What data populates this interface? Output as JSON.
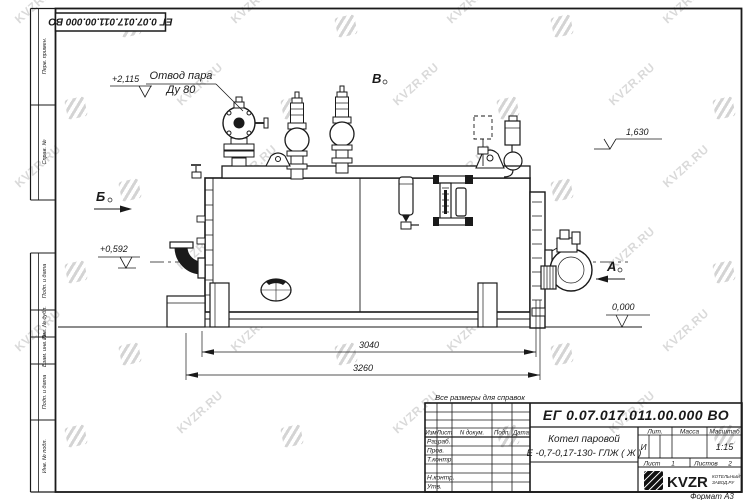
{
  "doc": {
    "number": "ЕГ 0.07.017.011.00.000  ВО",
    "number_top": "ЕГ 0.07.017.011.00.000  ВО",
    "title_line1": "Котел паровой",
    "title_line2": "Е -0,7-0,17-130- ГЛЖ ( Ж )",
    "litera_label": "Лит.",
    "litera": "И",
    "mass_label": "Масса",
    "scale_label": "Масштаб",
    "scale": "1:15",
    "sheet_label": "Лист",
    "sheet_value": "1",
    "sheets_label": "Листов",
    "sheets_value": "2",
    "format_label": "Формат А3",
    "reference_note": "Все размеры для справок"
  },
  "titleblock": {
    "header_cols": [
      "Изм",
      "Лист",
      "N докум.",
      "Подп.",
      "Дата"
    ],
    "rows": [
      "Разраб.",
      "Пров.",
      "Т.контр.",
      "",
      "Н.контр.",
      "Утв."
    ]
  },
  "frame_labels": [
    "Перв. примен.",
    "Справ. №",
    "Подп. и дата",
    "Инв. № дубл.",
    "Взам. инв. №",
    "Подп. и дата",
    "Инв. № подл."
  ],
  "logo": {
    "text": "KVZR",
    "caption_line1": "КОТЕЛЬНЫЙ",
    "caption_line2": "ЗАВОД.РУ"
  },
  "watermark": {
    "text": "KVZR.RU"
  },
  "annotations": {
    "steam_outlet_line1": "Отвод пара",
    "steam_outlet_line2": "Ду 80",
    "elev_top": "+2,115",
    "elev_right_top": "1,630",
    "elev_left": "+0,592",
    "elev_zero": "0,000",
    "dim_inner": "3040",
    "dim_outer": "3260",
    "view_a": "А",
    "view_b": "Б",
    "view_v": "В"
  },
  "colors": {
    "line": "#1a1a1a",
    "watermark": "rgba(0,0,0,0.15)"
  }
}
